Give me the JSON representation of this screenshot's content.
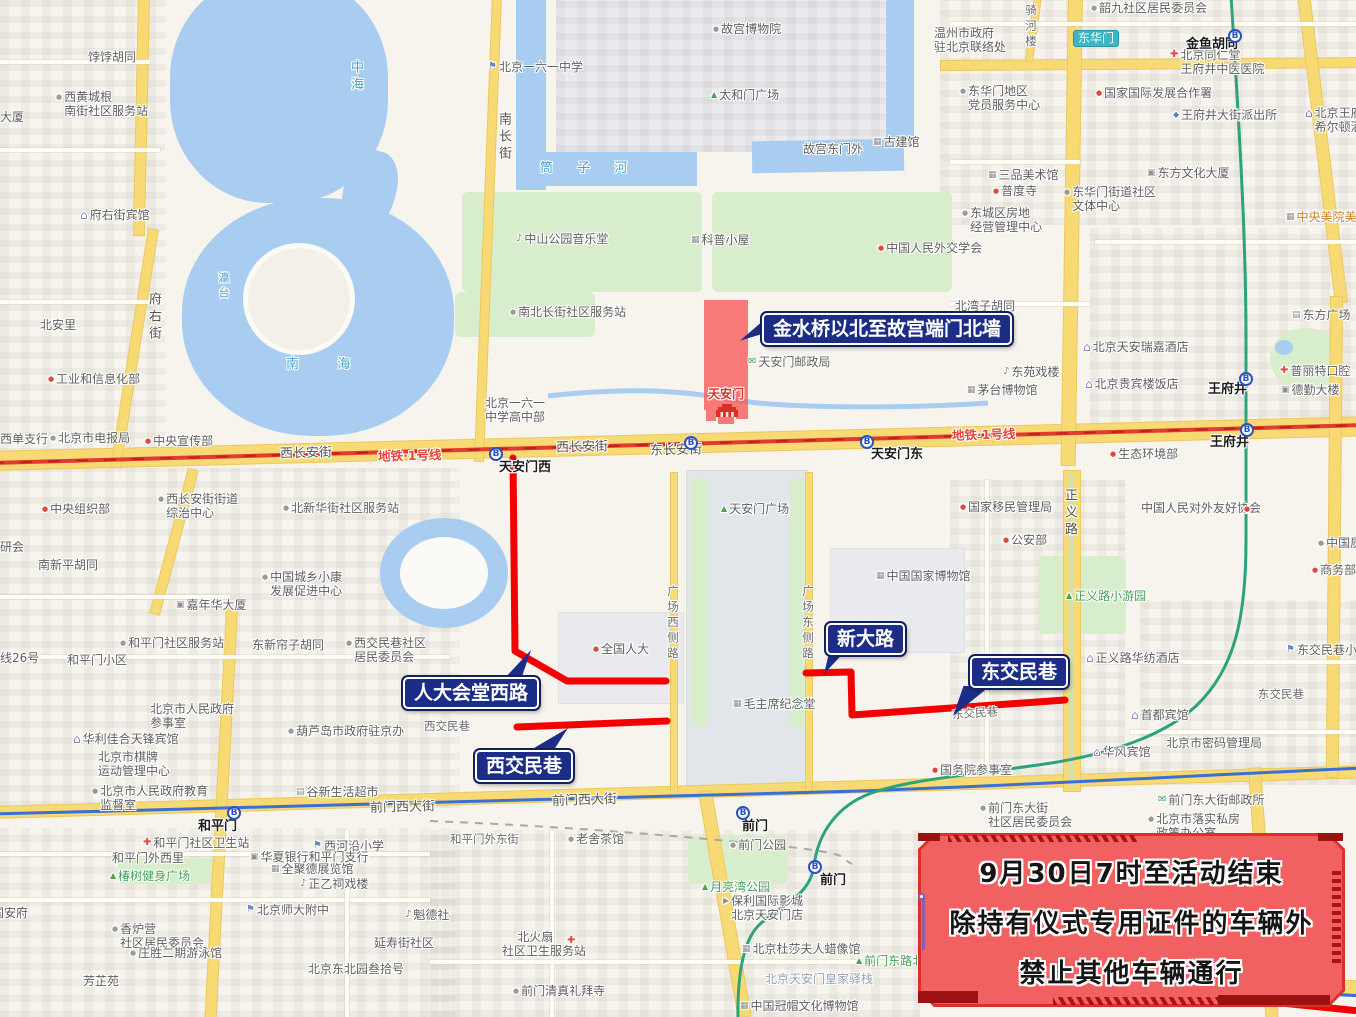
{
  "restricted_area": {
    "label": "天安门"
  },
  "notice": {
    "lines": [
      "9月30日7时至活动结束",
      "除持有仪式专用证件的车辆外",
      "禁止其他车辆通行"
    ],
    "accent_color": "#de2f2f"
  },
  "callouts": [
    {
      "text": "金水桥以北至故宫端门北墙",
      "x": 762,
      "y": 313,
      "tail": {
        "x": 740,
        "y": 316,
        "w": 26,
        "h": 28,
        "clip": "polygon(0 88%, 100% 8%, 100% 60%)"
      }
    },
    {
      "text": "人大会堂西路",
      "x": 403,
      "y": 677,
      "tail": {
        "x": 497,
        "y": 650,
        "w": 34,
        "h": 32,
        "clip": "polygon(100% 0, 12% 100%, 68% 100%)"
      }
    },
    {
      "text": "西交民巷",
      "x": 475,
      "y": 750,
      "tail": {
        "x": 520,
        "y": 728,
        "w": 48,
        "h": 26,
        "clip": "polygon(100% 0, 8% 100%, 65% 100%)"
      }
    },
    {
      "text": "新大路",
      "x": 826,
      "y": 623,
      "tail": {
        "x": 824,
        "y": 650,
        "w": 26,
        "h": 24,
        "clip": "polygon(0 100%, 22% 0, 85% 0)"
      }
    },
    {
      "text": "东交民巷",
      "x": 970,
      "y": 656,
      "tail": {
        "x": 953,
        "y": 686,
        "w": 42,
        "h": 30,
        "clip": "polygon(0 100%, 25% 0, 88% 0)"
      }
    }
  ],
  "routes": [
    {
      "name": "人大会堂西路",
      "path": "M513,458 L515,651 L567,681 L666,681"
    },
    {
      "name": "西交民巷",
      "path": "M517,727 L667,721"
    },
    {
      "name": "新大路-东交民巷",
      "path": "M806,673 L851,672 L852,715 L1065,700"
    },
    {
      "name": "东南段",
      "path": "M1262,1001 L1360,1011"
    }
  ],
  "map": {
    "route_color": "#f40000",
    "station_glyph": "B",
    "stations": [
      {
        "t": "天安门西",
        "ix": 489,
        "iy": 447,
        "lx": 499,
        "ly": 461
      },
      {
        "t": "",
        "ix": 684,
        "iy": 436
      },
      {
        "t": "天安门东",
        "ix": 860,
        "iy": 435,
        "lx": 871,
        "ly": 448
      },
      {
        "t": "王府井",
        "ix": 1239,
        "iy": 372,
        "lx": 1208,
        "ly": 383
      },
      {
        "t": "王府井",
        "ix": 1240,
        "iy": 423,
        "lx": 1210,
        "ly": 436
      },
      {
        "t": "和平门",
        "ix": 227,
        "iy": 806,
        "lx": 198,
        "ly": 820
      },
      {
        "t": "前门",
        "ix": 736,
        "iy": 806,
        "lx": 742,
        "ly": 820
      },
      {
        "t": "前门",
        "ix": 808,
        "iy": 860,
        "lx": 820,
        "ly": 874
      },
      {
        "t": "",
        "ix": 1228,
        "iy": 29
      }
    ],
    "labels": [
      {
        "t": "西长安街",
        "x": 280,
        "y": 447,
        "cls": "road",
        "rot": -1.5
      },
      {
        "t": "地铁·1号线",
        "x": 378,
        "y": 449,
        "cls": "metro",
        "rot": -1.5
      },
      {
        "t": "西长安街",
        "x": 556,
        "y": 441,
        "cls": "road",
        "rot": -1.5
      },
      {
        "t": "东长安街",
        "x": 650,
        "y": 444,
        "cls": "road",
        "rot": -1.5
      },
      {
        "t": "地铁·1号线",
        "x": 952,
        "y": 428,
        "cls": "metro",
        "rot": -1.5
      },
      {
        "t": "前门西大街",
        "x": 370,
        "y": 801,
        "cls": "road",
        "rot": -1.5
      },
      {
        "t": "前门西大街",
        "x": 552,
        "y": 794,
        "cls": "road",
        "rot": -2
      },
      {
        "t": "西交民巷",
        "x": 424,
        "y": 719,
        "cls": "roadsm"
      },
      {
        "t": "东交民巷",
        "x": 1258,
        "y": 687,
        "cls": "roadsm"
      },
      {
        "t": "东交民巷",
        "x": 952,
        "y": 706,
        "cls": "roadsm",
        "rot": -4
      },
      {
        "t": "和平门外东街",
        "x": 450,
        "y": 832,
        "cls": "roadsm"
      },
      {
        "t": "府右街",
        "x": 146,
        "y": 292,
        "cls": "vert"
      },
      {
        "t": "南长街",
        "x": 496,
        "y": 112,
        "cls": "vert"
      },
      {
        "t": "广场西侧路",
        "x": 666,
        "y": 585,
        "cls": "roadsm vert"
      },
      {
        "t": "广场东侧路",
        "x": 801,
        "y": 585,
        "cls": "roadsm vert"
      },
      {
        "t": "正义路",
        "x": 1062,
        "y": 488,
        "cls": "vert"
      },
      {
        "t": "骑河楼",
        "x": 1024,
        "y": 4,
        "cls": "roadsm vert"
      },
      {
        "t": "中海",
        "x": 348,
        "y": 60,
        "cls": "water vert"
      },
      {
        "t": "瀛台",
        "x": 216,
        "y": 272,
        "cls": "water vert sm"
      },
      {
        "t": "南  海",
        "x": 286,
        "y": 358,
        "cls": "water sp"
      },
      {
        "t": "筒 子 河",
        "x": 540,
        "y": 162,
        "cls": "water sp"
      },
      {
        "t": "金鱼胡同",
        "x": 1186,
        "y": 38,
        "cls": "st"
      },
      {
        "t": "东华门",
        "x": 1073,
        "y": 30,
        "cls": "badge"
      }
    ],
    "pois": [
      {
        "t": "饽饽胡同",
        "x": 88,
        "y": 50
      },
      {
        "t": "西黄城根\n南街社区服务站",
        "x": 56,
        "y": 90,
        "ic": "dot"
      },
      {
        "t": "大厦",
        "x": 0,
        "y": 110
      },
      {
        "t": "府右街宾馆",
        "x": 80,
        "y": 208,
        "ic": "hotel"
      },
      {
        "t": "北安里",
        "x": 40,
        "y": 318
      },
      {
        "t": "工业和信息化部",
        "x": 48,
        "y": 372,
        "ic": "dotr"
      },
      {
        "t": "西单支行",
        "x": 0,
        "y": 432
      },
      {
        "t": "北京市电报局",
        "x": 50,
        "y": 431,
        "ic": "dot"
      },
      {
        "t": "中央宣传部",
        "x": 145,
        "y": 434,
        "ic": "dotr"
      },
      {
        "t": "北京一六一中学",
        "x": 488,
        "y": 60,
        "ic": "sch"
      },
      {
        "t": "故宫博物院",
        "x": 713,
        "y": 22,
        "ic": "dot"
      },
      {
        "t": "太和门广场",
        "x": 711,
        "y": 88,
        "ic": "tree"
      },
      {
        "t": "故宫东门外",
        "x": 803,
        "y": 142
      },
      {
        "t": "古建馆",
        "x": 873,
        "y": 135,
        "ic": "mus"
      },
      {
        "t": "中山公园音乐堂",
        "x": 516,
        "y": 232,
        "ic": "thea"
      },
      {
        "t": "科普小屋",
        "x": 691,
        "y": 233,
        "ic": "mus"
      },
      {
        "t": "中国人民外交学会",
        "x": 878,
        "y": 241,
        "ic": "dotr"
      },
      {
        "t": "南北长街社区服务站",
        "x": 510,
        "y": 305,
        "ic": "dot"
      },
      {
        "t": "北京一六一\n中学高中部",
        "x": 485,
        "y": 396
      },
      {
        "t": "天安门邮政局",
        "x": 748,
        "y": 355,
        "ic": "post"
      },
      {
        "t": "北湾子胡同",
        "x": 955,
        "y": 299
      },
      {
        "t": "东苑戏楼",
        "x": 1003,
        "y": 365,
        "ic": "thea"
      },
      {
        "t": "茅台博物馆",
        "x": 967,
        "y": 383,
        "ic": "mus"
      },
      {
        "t": "韶九社区居民委员会",
        "x": 1091,
        "y": 1,
        "ic": "dot"
      },
      {
        "t": "温州市政府\n驻北京联络处",
        "x": 934,
        "y": 26
      },
      {
        "t": "东华门地区\n党员服务中心",
        "x": 960,
        "y": 84,
        "ic": "dot"
      },
      {
        "t": "北京同仁堂\n王府井中医医院",
        "x": 1170,
        "y": 48,
        "ic": "hosp"
      },
      {
        "t": "国家国际发展合作署",
        "x": 1096,
        "y": 86,
        "ic": "dotr"
      },
      {
        "t": "王府井大街派出所",
        "x": 1173,
        "y": 108,
        "ic": "pol"
      },
      {
        "t": "北京王府井\n希尔顿酒店",
        "x": 1305,
        "y": 106,
        "ic": "hotel"
      },
      {
        "t": "三品美术馆",
        "x": 988,
        "y": 168,
        "ic": "mus"
      },
      {
        "t": "普度寺",
        "x": 993,
        "y": 184,
        "ic": "dotr"
      },
      {
        "t": "东方文化大厦",
        "x": 1147,
        "y": 166,
        "ic": "bank"
      },
      {
        "t": "东华门街道社区\n文体中心",
        "x": 1064,
        "y": 185,
        "ic": "dot"
      },
      {
        "t": "东城区房地\n经营管理中心",
        "x": 962,
        "y": 206,
        "ic": "dot"
      },
      {
        "t": "中央美院美术馆",
        "x": 1286,
        "y": 210,
        "ic": "mus",
        "c": "orange"
      },
      {
        "t": "东方广场",
        "x": 1292,
        "y": 308,
        "ic": "shop"
      },
      {
        "t": "北京天安瑞嘉酒店",
        "x": 1083,
        "y": 340,
        "ic": "hotel"
      },
      {
        "t": "北京贵宾楼饭店",
        "x": 1085,
        "y": 377,
        "ic": "hotel"
      },
      {
        "t": "普丽特口腔",
        "x": 1280,
        "y": 364,
        "ic": "hosp"
      },
      {
        "t": "德勤大楼",
        "x": 1281,
        "y": 383,
        "ic": "bank"
      },
      {
        "t": "生态环境部",
        "x": 1110,
        "y": 447,
        "ic": "dotr"
      },
      {
        "t": "西长安街街道\n综治中心",
        "x": 158,
        "y": 492,
        "ic": "dot"
      },
      {
        "t": "中央组织部",
        "x": 42,
        "y": 502,
        "ic": "dotr"
      },
      {
        "t": "北新华街社区服务站",
        "x": 283,
        "y": 501,
        "ic": "dot"
      },
      {
        "t": "研会",
        "x": 0,
        "y": 540
      },
      {
        "t": "南新平胡同",
        "x": 38,
        "y": 558
      },
      {
        "t": "中国城乡小康\n发展促进中心",
        "x": 262,
        "y": 570,
        "ic": "dot"
      },
      {
        "t": "嘉年华大厦",
        "x": 176,
        "y": 598,
        "ic": "bank"
      },
      {
        "t": "和平门社区服务站",
        "x": 120,
        "y": 636,
        "ic": "dot"
      },
      {
        "t": "和平门小区",
        "x": 67,
        "y": 653
      },
      {
        "t": "东新帘子胡同",
        "x": 252,
        "y": 638
      },
      {
        "t": "西交民巷社区\n居民委员会",
        "x": 346,
        "y": 636,
        "ic": "dot"
      },
      {
        "t": "线26号",
        "x": 0,
        "y": 651
      },
      {
        "t": "天安门广场",
        "x": 721,
        "y": 502,
        "ic": "tree"
      },
      {
        "t": "全国人大",
        "x": 593,
        "y": 642,
        "ic": "dotr"
      },
      {
        "t": "国家移民管理局",
        "x": 960,
        "y": 500,
        "ic": "dotr"
      },
      {
        "t": "公安部",
        "x": 1003,
        "y": 533,
        "ic": "dotr"
      },
      {
        "t": "中国国家博物馆",
        "x": 876,
        "y": 569,
        "ic": "mus"
      },
      {
        "t": "中国人民对外友好协会",
        "x": 1141,
        "y": 501
      },
      {
        "t": "",
        "x": 1244,
        "y": 502,
        "ic": "dotr"
      },
      {
        "t": "中国质量",
        "x": 1318,
        "y": 536,
        "ic": "dot"
      },
      {
        "t": "商务部",
        "x": 1312,
        "y": 563,
        "ic": "dotr"
      },
      {
        "t": "正义路小游园",
        "x": 1066,
        "y": 589,
        "ic": "tree",
        "c": "park"
      },
      {
        "t": "东交民巷小学",
        "x": 1286,
        "y": 643,
        "ic": "sch"
      },
      {
        "t": "正义路华纺酒店",
        "x": 1086,
        "y": 651,
        "ic": "hotel"
      },
      {
        "t": "毛主席纪念堂",
        "x": 733,
        "y": 697,
        "ic": "mus"
      },
      {
        "t": "首都宾馆",
        "x": 1131,
        "y": 708,
        "ic": "hotel"
      },
      {
        "t": "华风宾馆",
        "x": 1093,
        "y": 745,
        "ic": "hotel"
      },
      {
        "t": "北京市密码管理局",
        "x": 1166,
        "y": 736
      },
      {
        "t": "国务院参事室",
        "x": 932,
        "y": 763,
        "ic": "dotr"
      },
      {
        "t": "北京市人民政府\n参事室",
        "x": 150,
        "y": 702
      },
      {
        "t": "葫芦岛市政府驻京办",
        "x": 288,
        "y": 724,
        "ic": "dot"
      },
      {
        "t": "华利佳合天锋宾馆",
        "x": 73,
        "y": 732,
        "ic": "hotel"
      },
      {
        "t": "北京市棋牌\n运动管理中心",
        "x": 98,
        "y": 750
      },
      {
        "t": "北京市人民政府教育\n监督室",
        "x": 92,
        "y": 784,
        "ic": "dot"
      },
      {
        "t": "谷新生活超市",
        "x": 296,
        "y": 785,
        "ic": "shop"
      },
      {
        "t": "前门东大街\n社区居民委员会",
        "x": 980,
        "y": 801,
        "ic": "dot"
      },
      {
        "t": "和平门社区卫生站",
        "x": 143,
        "y": 836,
        "ic": "hosp"
      },
      {
        "t": "和平门外西里",
        "x": 112,
        "y": 851
      },
      {
        "t": "椿树健身广场",
        "x": 110,
        "y": 869,
        "ic": "tree",
        "c": "park"
      },
      {
        "t": "西河沿小学",
        "x": 313,
        "y": 839,
        "ic": "sch"
      },
      {
        "t": "华夏银行和平门支行",
        "x": 250,
        "y": 850,
        "ic": "bank"
      },
      {
        "t": "全聚德展览馆",
        "x": 271,
        "y": 862,
        "ic": "mus"
      },
      {
        "t": "正乙祠戏楼",
        "x": 300,
        "y": 877,
        "ic": "thea"
      },
      {
        "t": "北京师大附中",
        "x": 246,
        "y": 903,
        "ic": "sch"
      },
      {
        "t": "香炉营\n社区居民委员会",
        "x": 112,
        "y": 922,
        "ic": "dot"
      },
      {
        "t": "庄胜二期游泳馆",
        "x": 130,
        "y": 946,
        "ic": "dot"
      },
      {
        "t": "芳芷苑",
        "x": 83,
        "y": 974
      },
      {
        "t": "国安府",
        "x": -8,
        "y": 906
      },
      {
        "t": "北京东北园叁拾号",
        "x": 308,
        "y": 962
      },
      {
        "t": "延寿街社区",
        "x": 374,
        "y": 936
      },
      {
        "t": "魁德社",
        "x": 405,
        "y": 908,
        "ic": "thea"
      },
      {
        "t": "老舍茶馆",
        "x": 568,
        "y": 832,
        "ic": "dot"
      },
      {
        "t": "    北火扇\n社区卫生服务站",
        "x": 502,
        "y": 930
      },
      {
        "t": "",
        "x": 567,
        "y": 934,
        "ic": "hosp"
      },
      {
        "t": "前门清真礼拜寺",
        "x": 513,
        "y": 984,
        "ic": "dot"
      },
      {
        "t": "前门公园",
        "x": 730,
        "y": 838,
        "ic": "dot"
      },
      {
        "t": "月亮湾公园",
        "x": 702,
        "y": 880,
        "ic": "tree",
        "c": "park"
      },
      {
        "t": "保利国际影城\n北京天安门店",
        "x": 723,
        "y": 894,
        "ic": "cin"
      },
      {
        "t": "北京杜莎夫人蜡像馆",
        "x": 742,
        "y": 942,
        "ic": "mus"
      },
      {
        "t": "前门东路北部花园",
        "x": 856,
        "y": 954,
        "ic": "tree",
        "c": "park"
      },
      {
        "t": "北京天安门皇家驿栈",
        "x": 765,
        "y": 972,
        "c": "muted"
      },
      {
        "t": "中国冠帽文化博物馆",
        "x": 740,
        "y": 999,
        "ic": "mus"
      },
      {
        "t": "前门东大街邮政所",
        "x": 1158,
        "y": 793,
        "ic": "post"
      },
      {
        "t": "北京市落实私房\n政策办公室",
        "x": 1148,
        "y": 812,
        "ic": "dot"
      },
      {
        "t": "北京新世界",
        "x": 1270,
        "y": 877,
        "ic": "hotel"
      },
      {
        "t": "北京电力",
        "x": 1286,
        "y": 937,
        "ic": "bank"
      }
    ]
  }
}
